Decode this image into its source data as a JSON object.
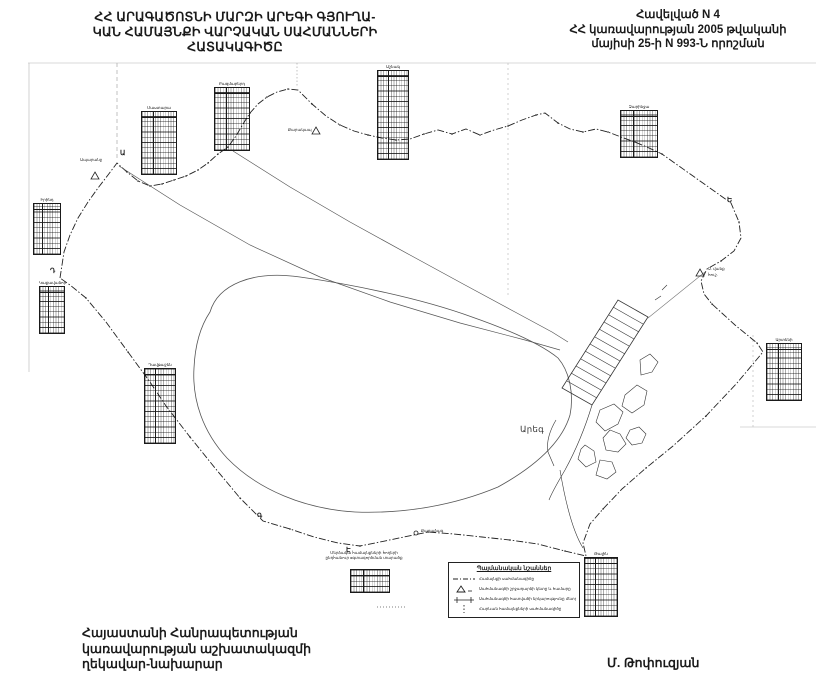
{
  "header": {
    "title_lines": [
      "ՀՀ ԱՐԱԳԱԾՈՏՆԻ ՄԱՐԶԻ ԱՐԵԳԻ ԳՅՈՒՂԱ-",
      "ԿԱՆ ՀԱՄԱՅՆՔԻ ՎԱՐՉԱԿԱՆ ՍԱՀՄԱՆՆԵՐԻ",
      "ՀԱՏԱԿԱԳԻԾԸ"
    ],
    "annex_lines": [
      "Հավելված N 4",
      "ՀՀ կառավարության 2005 թվականի",
      "մայիսի 25-ի N 993-Ն որոշման"
    ]
  },
  "footer": {
    "agency_lines": [
      "Հայաստանի Հանրապետության",
      "կառավարության աշխատակազմի",
      "ղեկավար-նախարար"
    ],
    "signature": "Մ. Թոփուզյան"
  },
  "legend": {
    "title": "Պայմանական նշաններ",
    "items": [
      {
        "symbol": "dash-dot-line",
        "label": "Համայնքի սահմանագիծը"
      },
      {
        "symbol": "triangle-point",
        "label": "Սահմանագծի շրջադարձի կետը և համարը"
      },
      {
        "symbol": "segment-ticks",
        "label": "Սահմանագծի հատվածի երկարությունը մետրերով"
      },
      {
        "symbol": "dotted-line",
        "label": "Հարևան համայնքների սահմանագիծը"
      }
    ]
  },
  "map": {
    "settlement": "Արեգ",
    "labels": {
      "aparan": "Ապարանջ",
      "karakap": "Քարակապ",
      "vank_line1": "Ս. վանք",
      "vank_line2": "հուշ.",
      "karadzag": "Քարաձագ",
      "note_line1": "Մերձակա համայնքների հողերի",
      "note_line2": "ընդհանուր օգտագործման տարածք"
    },
    "vertex_letters": [
      {
        "t": "Ա"
      },
      {
        "t": "Ե"
      },
      {
        "t": "Գ"
      },
      {
        "t": "Դ"
      },
      {
        "t": "Է"
      }
    ],
    "tables": [
      {
        "caption": "Մաստարա"
      },
      {
        "caption": "Բազմաբերդ"
      },
      {
        "caption": "Աշնակ"
      },
      {
        "caption": "Իրինդ"
      },
      {
        "caption": "Կաքավաձոր"
      },
      {
        "caption": "Դավթաշեն"
      },
      {
        "caption": "Զարինջա"
      },
      {
        "caption": "Արտենի"
      },
      {
        "caption": "Թալին"
      },
      {
        "caption": ""
      }
    ]
  }
}
